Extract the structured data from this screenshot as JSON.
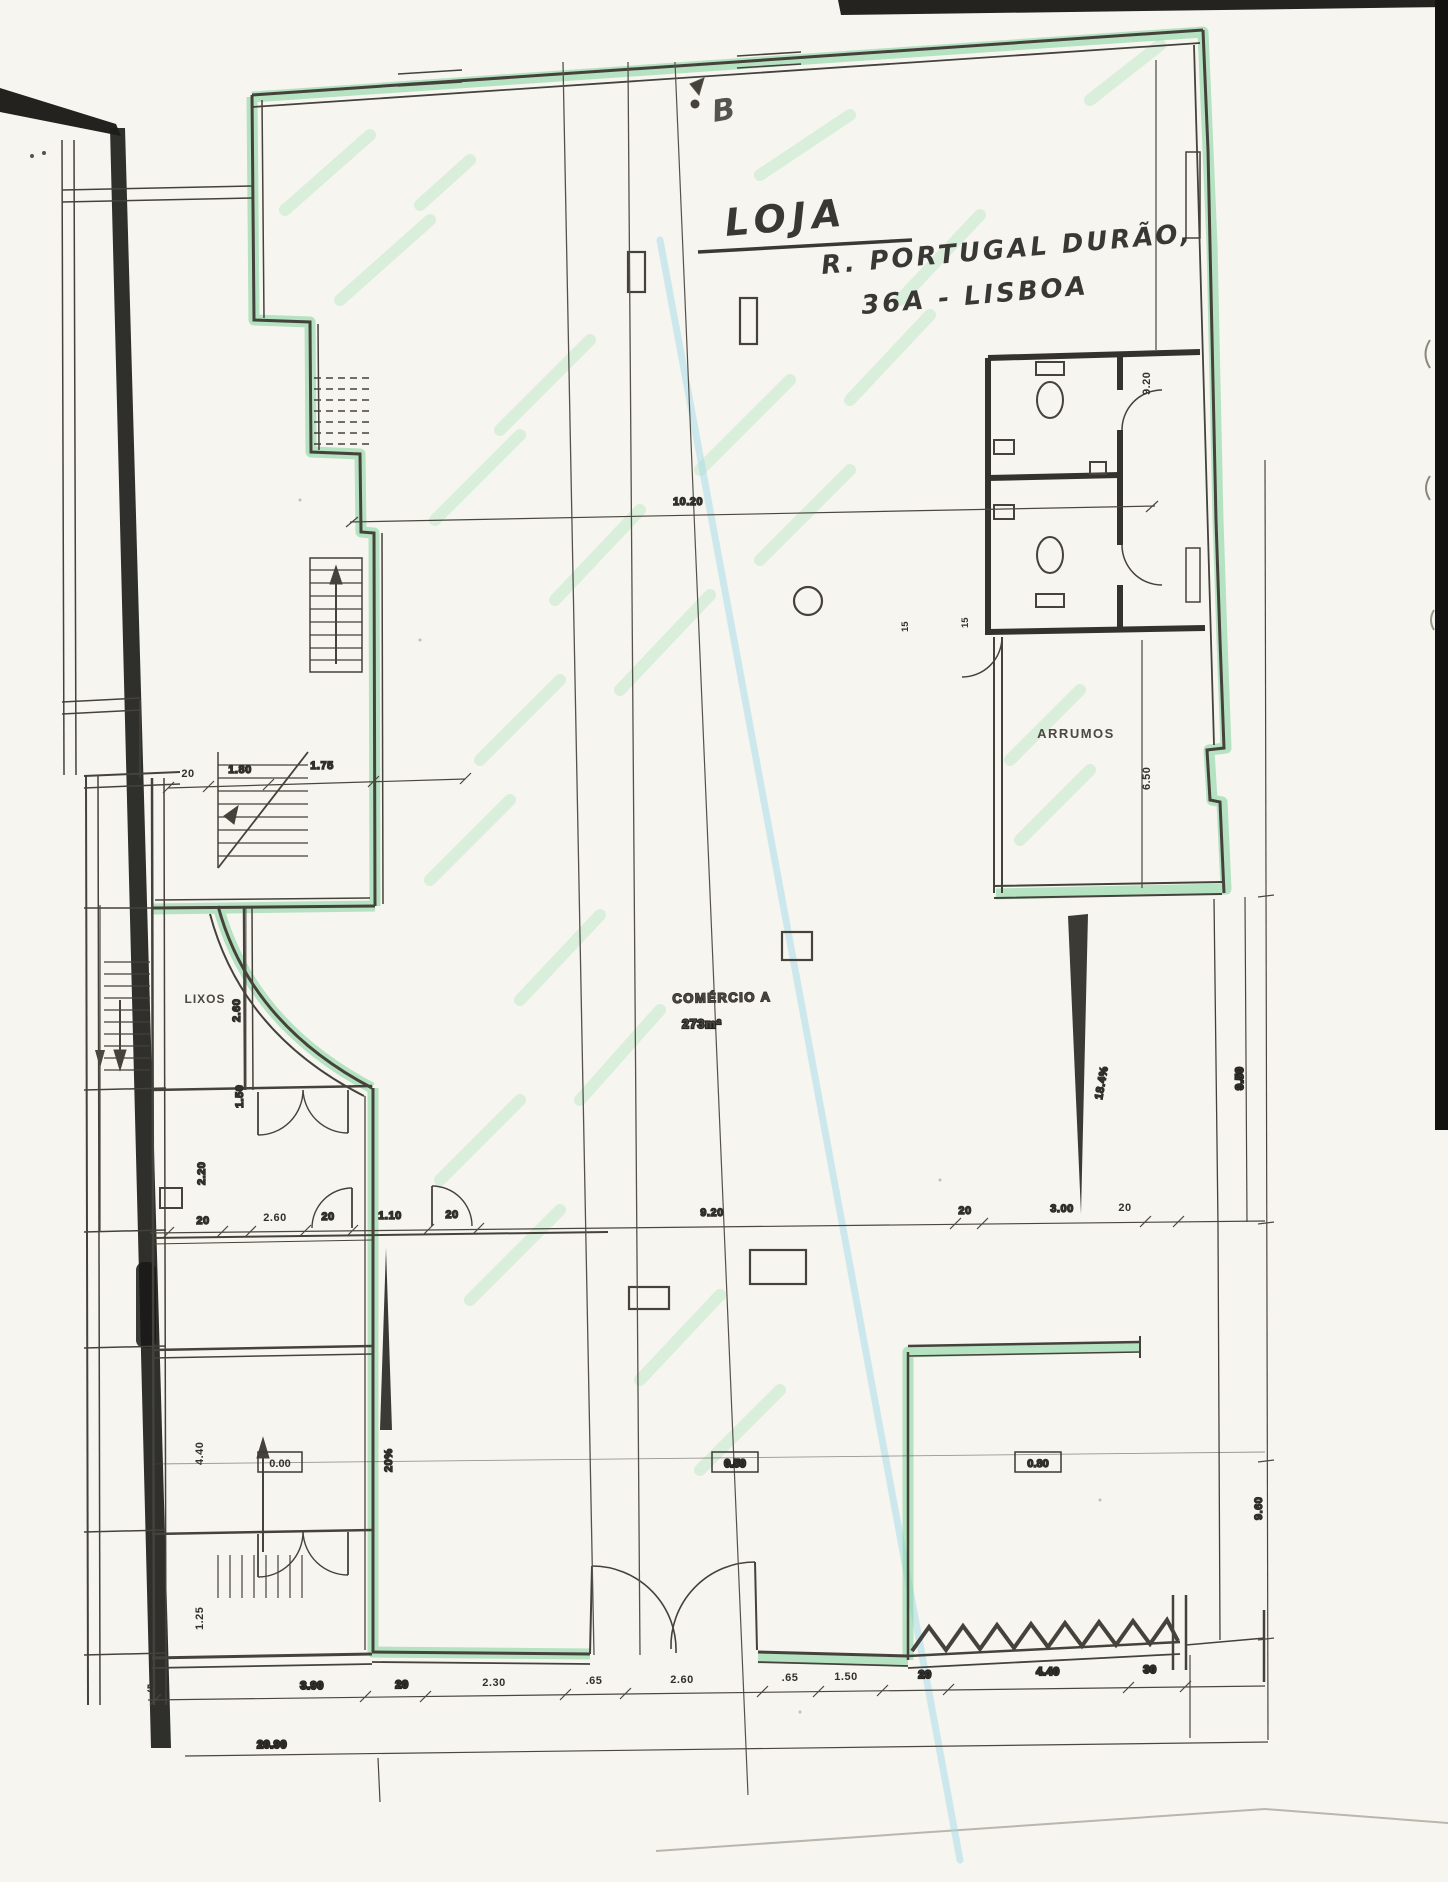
{
  "annotations": {
    "title_line1": "LOJA",
    "title_line2": "R. PORTUGAL DURÃO,",
    "title_line3": "36A - LISBOA",
    "section_marker": "B"
  },
  "rooms": {
    "storage": "ARRUMOS",
    "trash": "LIXOS",
    "commerce_name": "COMÉRCIO A",
    "commerce_area": "273m²"
  },
  "levels": {
    "left": "0.00",
    "center": "0.50",
    "right": "0.80"
  },
  "ramps": {
    "left_slope": "20%",
    "right_slope": "18.4%"
  },
  "dimensions": {
    "top_span": "10.20",
    "upper_left": [
      "20",
      "1.80",
      "1.75"
    ],
    "right_side": {
      "top": "9.20",
      "storage": "6.50",
      "lower": "9.50",
      "bottom": "9.60"
    },
    "middle_row": [
      "20",
      "2.60",
      "20",
      "1.10",
      "20",
      "9.20",
      "20",
      "3.00",
      "20"
    ],
    "bottom_row": [
      "5",
      "3.90",
      "20",
      "2.30",
      ".65",
      "2.60",
      ".65",
      "1.50",
      "20",
      "4.40",
      "30"
    ],
    "overall_width": "20.90",
    "left_side": [
      "2.60",
      "1.50",
      "2.20",
      "4.40",
      "1.25"
    ],
    "wc_small": [
      "15",
      "15"
    ]
  },
  "colors": {
    "highlight_green": "#87d49e",
    "hatch_green": "#b7e7c3",
    "highlight_cyan": "#a6dcea",
    "ink": "#45423b",
    "paper": "#f6f5f0"
  }
}
